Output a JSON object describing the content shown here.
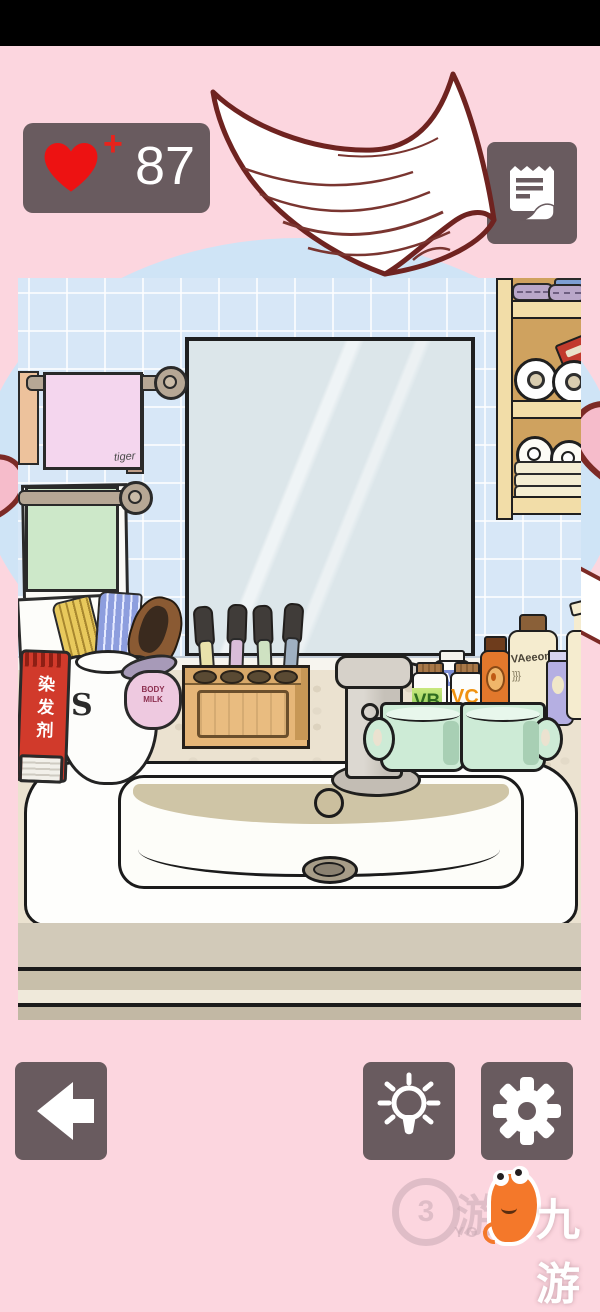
{
  "hud": {
    "hearts_count": "87",
    "heart_plus": "+"
  },
  "scene": {
    "towel_label": "tiger",
    "jar_label": "BODY MILK",
    "tube_label": "染发剂",
    "bottle_vb": "VB",
    "bottle_m": "M",
    "bottle_vc": "VC",
    "bottle_cream": "VAeeon",
    "squiggle_left": "}}}",
    "squiggle_right": "{{{"
  },
  "watermark": {
    "badge_number": "3",
    "badge_char": "游",
    "badge_sub": "YO",
    "brand": "九游"
  },
  "colors": {
    "background_pink": "#fcd6df",
    "panel_gray": "#695b5f",
    "heart_red": "#ed1212",
    "tile_blue": "#d7e7f7",
    "mascot_orange": "#f4782a"
  }
}
